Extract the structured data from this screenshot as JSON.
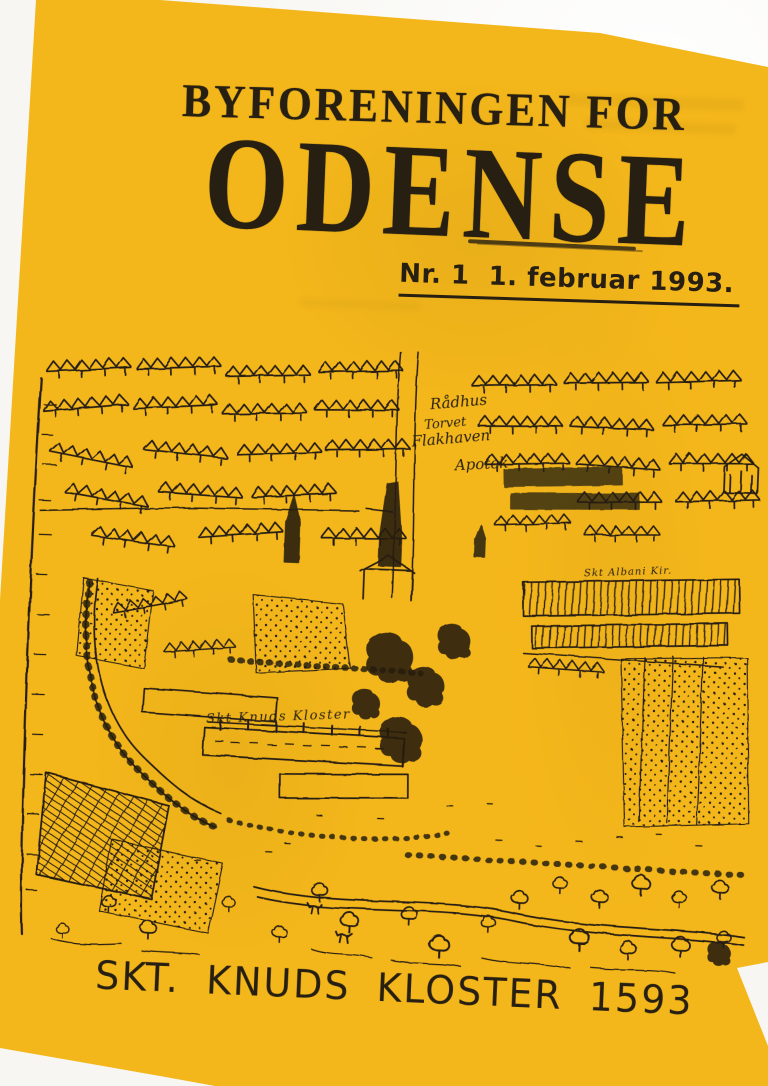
{
  "document": {
    "kind": "scanned newsletter front page"
  },
  "colors": {
    "page_yellow": "#f4b71b",
    "ink": "#271f12",
    "backdrop": "#f7f6f2"
  },
  "header": {
    "line1": "BYFORENINGEN FOR",
    "line2": "ODENSE"
  },
  "issue": {
    "text": "Nr. 1  1. februar 1993."
  },
  "map": {
    "labels": {
      "radhus": "Rådhus",
      "torvet": "Torvet",
      "flakhaven": "Flakhaven",
      "apotek": "Apotek",
      "albani": "Skt Albani Kir.",
      "kloster": "Skt Knuds Kloster"
    }
  },
  "caption": {
    "text": "SKT. KNUDS KLOSTER 1593"
  }
}
